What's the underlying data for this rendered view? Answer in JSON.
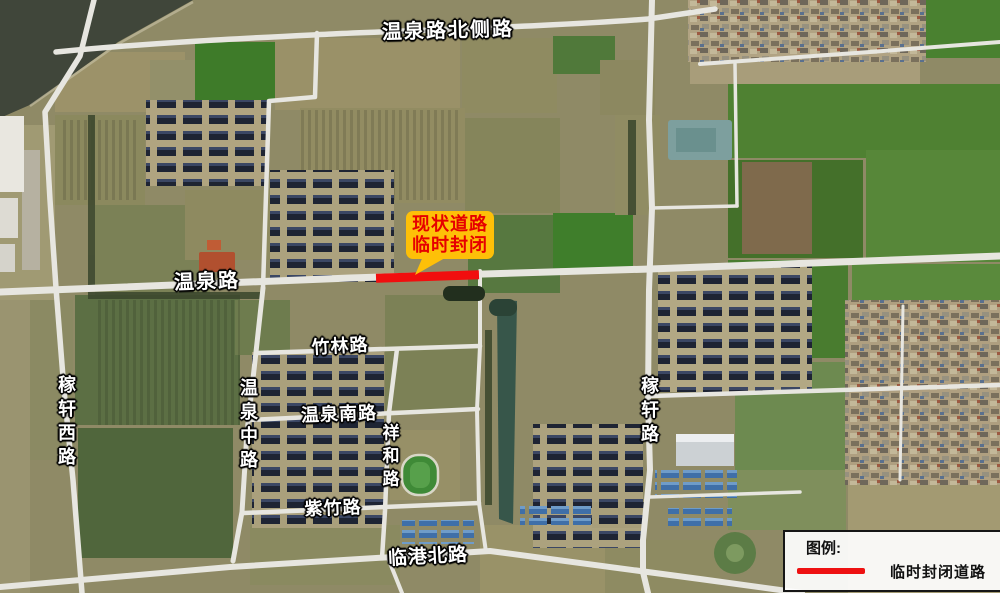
{
  "map_type": "satellite-annotated-road-closure-map",
  "roads": {
    "top": "温泉路北侧路",
    "wenquan": "温泉路",
    "jiaxuan_west": "稼轩西路",
    "wenquan_middle": "温泉中路",
    "zhulin": "竹林路",
    "wenquan_south": "温泉南路",
    "xianghe": "祥和路",
    "zizhu": "紫竹路",
    "lingang_north": "临港北路",
    "jiaxuan": "稼轩路"
  },
  "callout": {
    "line1": "现状道路",
    "line2": "临时封闭"
  },
  "legend": {
    "title": "图例:",
    "item_label": "临时封闭道路"
  },
  "colors": {
    "closed_road": "#f10e0e",
    "legend_line": "#ee1111",
    "callout_bg": "#fec008",
    "callout_text": "#e60000",
    "road_label_text": "#ffffff",
    "road_label_outline": "#000000"
  }
}
